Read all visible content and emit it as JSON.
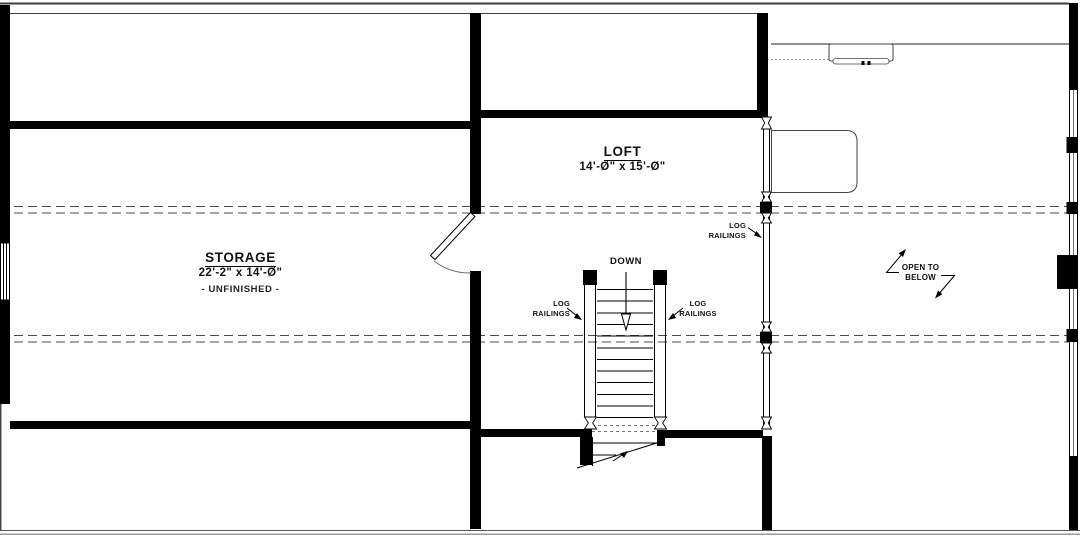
{
  "drawing": {
    "type": "second-floor loft plan",
    "colors": {
      "ink": "#000000",
      "dash": "#4a4a4a",
      "eave": "#8a8a8a"
    },
    "rooms": {
      "loft": {
        "title": "LOFT",
        "dims": "14'-Ø\" x 15'-Ø\""
      },
      "storage": {
        "title": "STORAGE",
        "dims": "22'-2\" x 14'-Ø\"",
        "note": "- UNFINISHED -"
      },
      "open_to_below": {
        "line1": "OPEN TO",
        "line2": "BELOW"
      }
    },
    "stairs": {
      "down_label": "DOWN"
    },
    "log_railings_label": {
      "line1": "LOG",
      "line2": "RAILINGS"
    }
  }
}
